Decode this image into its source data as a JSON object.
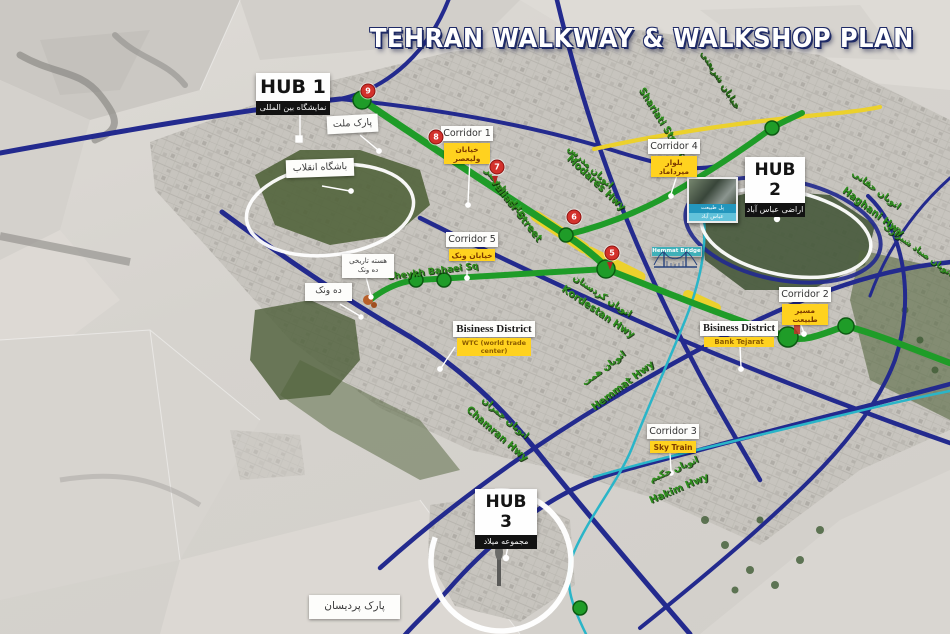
{
  "title": "TEHRAN WALKWAY & WALKSHOP PLAN",
  "colors": {
    "route_blue": "#232a8e",
    "route_green": "#1f9c28",
    "route_yellow": "#ecd12c",
    "route_cyan": "#2ab5c8",
    "marker_red": "#d3312c",
    "callout_yellow": "#ffd21f"
  },
  "hubs": [
    {
      "label": "HUB 1",
      "sub": "نمایشگاه بین المللی"
    },
    {
      "label": "HUB 2",
      "sub": "اراضی عباس آباد"
    },
    {
      "label": "HUB 3",
      "sub": "مجموعه میلاد"
    }
  ],
  "corridors": [
    {
      "label": "Corridor 1",
      "sub": "خیابان ولیعصر"
    },
    {
      "label": "Corridor 2",
      "sub": "مسیر طبیعت"
    },
    {
      "label": "Corridor 3",
      "sub": "Sky Train"
    },
    {
      "label": "Corridor 4",
      "sub": "بلوار میرداماد"
    },
    {
      "label": "Corridor 5",
      "sub": "خیابان ونک"
    }
  ],
  "districts": [
    {
      "name": "Bisiness District",
      "sub": "WTC (world trade center)"
    },
    {
      "name": "Bisiness District",
      "sub": "Bank Tejarat"
    }
  ],
  "places": {
    "mellat": "پارک ملت",
    "enghelab": "باشگاه انقلاب",
    "core1": "هسته تاریخی",
    "core2": "ده ونک",
    "dehvanak": "ده ونک",
    "pardisan": "پارک پردیسان"
  },
  "streets": {
    "valiasr_en": "Valiasr Street",
    "valiasr_fa": "خیابان ولیعصر",
    "modares_en": "Modares Hwy",
    "modares_fa": "اتوبان مدرس",
    "shariati_en": "Shariati Street",
    "shariati_fa": "خیابان شریعتی",
    "kordestan_en": "Kordestan Hwy",
    "kordestan_fa": "اتوبان کردستان",
    "hemmat_en": "Hemmat Hwy",
    "hemmat_fa": "اتوبان همت",
    "chamran_en": "Chamran Hwy",
    "chamran_fa": "اتوبان چمران",
    "hakim_en": "Hakim Hwy",
    "hakim_fa": "اتوبان حکیم",
    "haghani_en": "Haghani Hwy",
    "haghani_fa": "اتوبان حقانی",
    "sheykh_en": "Sheykh Bahaei Sq",
    "sayyad_fa": "اتوبان صیاد شیرازی"
  },
  "markers": {
    "m5": "5",
    "m6": "6",
    "m7": "7",
    "m8": "8",
    "m9": "9"
  },
  "cards": {
    "photo": {
      "line1": "پل طبیعت",
      "line2": "عباس آباد"
    },
    "sketch": {
      "caption": "Hemmat Bridge"
    }
  }
}
